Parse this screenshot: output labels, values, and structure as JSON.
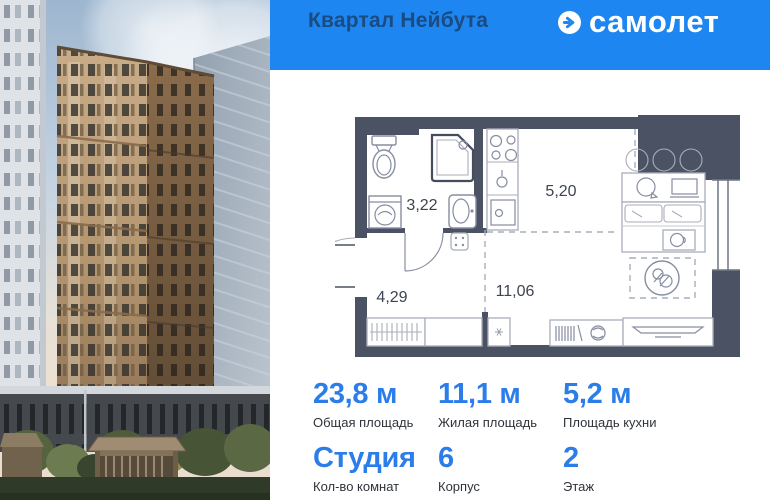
{
  "header": {
    "project_title": "Квартал Нейбута",
    "brand_name": "самолет",
    "bg_color": "#1e86f0",
    "title_color": "#1a4b82",
    "brand_icon": "arrow-right-in-circle"
  },
  "floor_plan": {
    "rooms": {
      "bathroom_area": "3,22",
      "kitchen_area": "5,20",
      "hallway_area": "4,29",
      "living_area": "11,06"
    },
    "wall_color": "#4b5263"
  },
  "stats": {
    "value_color": "#2b7de9",
    "cells": [
      {
        "value": "23,8 м",
        "label": "Общая площадь"
      },
      {
        "value": "11,1 м",
        "label": "Жилая площадь"
      },
      {
        "value": "5,2 м",
        "label": "Площадь кухни"
      },
      {
        "value": "Студия",
        "label": "Кол-во комнат"
      },
      {
        "value": "6",
        "label": "Корпус"
      },
      {
        "value": "2",
        "label": "Этаж"
      }
    ]
  }
}
